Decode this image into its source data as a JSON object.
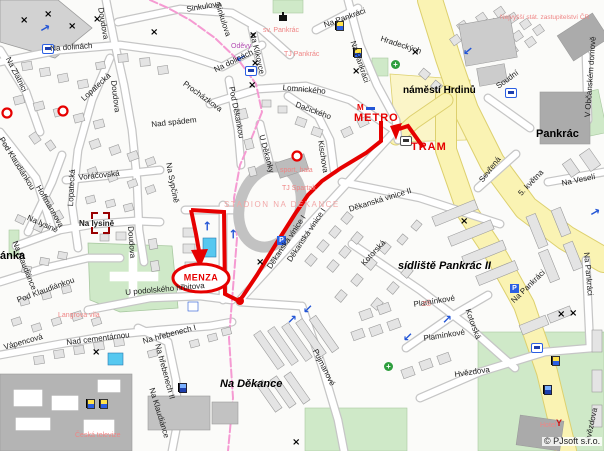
{
  "map": {
    "copyright": "© PJsoft s.r.o.",
    "colors": {
      "route_red": "#e60000",
      "boundary_pink": "#f59ad2",
      "road_yellow": "#faf3b3",
      "park_green": "#cfe9c8",
      "highlight_building_cyan": "#56c8f0",
      "poi_pink": "#ef8585",
      "shop_purple": "#b44fb4"
    },
    "route": {
      "metro_label": "METRO",
      "tram_label": "TRAM",
      "destination_label": "MENZA"
    },
    "districts": [
      "náměstí Hrdinů",
      "sídliště Pankrác II",
      "Pankrác",
      "Na Děkance",
      "ánka"
    ],
    "streets": [
      "Sinkulova",
      "Sinkulova",
      "Doudova",
      "Doudova",
      "Doudova",
      "Na dolinách",
      "Na dolinách",
      "Na Zlatnici",
      "Lopatecká",
      "Lopatecká",
      "Voráčovská",
      "Hoffmannova",
      "Pod Klaudiánkou",
      "Pod Klaudiánkou",
      "Na lysině",
      "Na lysině",
      "Na Klaudiánce",
      "Na Klaudiánce",
      "U podolského hřbitova",
      "Vápencová",
      "Nad cementárnou",
      "Na hřebenech I",
      "Na hřebenech II",
      "Pujmanové",
      "Na Klikovce",
      "Lomnického",
      "Pod Děkankou",
      "U Děkanky",
      "Dačického",
      "Kischova",
      "Děkanská vinice I",
      "Děkanská vinice I",
      "Děkanská vinice II",
      "Kotorská",
      "Kotorská",
      "Plamínkové",
      "Plamínkové",
      "Hvězdova",
      "Hvězdova",
      "5. května",
      "Na Veselí",
      "Sevřená",
      "Soudní",
      "Na Pankráci",
      "Na Pankráci",
      "Na Pankráci",
      "Na Pankráci",
      "Hradeckých",
      "Procházkova",
      "Nad spádem",
      "Na Sypčině",
      "V Občanském domově"
    ],
    "pois": [
      "sv. Pankrác",
      "TJ Pankrác",
      "Oděvy",
      "sport. hala",
      "TJ Spartak",
      "STADION NA DĚKANCE",
      "Langrova vila",
      "Česká televize",
      "ZŠ",
      "Hotel",
      "Nejvyšší stát. zastupitelství ČR"
    ],
    "icons": {
      "bus-stop-icon": "white square, blue border, bus glyph",
      "tram-stop-icon": "white square, gray border, tram glyph",
      "parking-icon": "blue square with white P",
      "one-way-arrow-icon": "blue arrow",
      "crossing-icon": "black x mark",
      "flag-icon": "yellow/blue flag",
      "flag-icon-blue": "blue flag",
      "pharmacy-icon": "green circle with white cross",
      "church-icon": "black chapel",
      "restaurant-icon": "red glass",
      "metro-icon": "red M with blue dash",
      "route-destination-oval": "red oval outline",
      "route-arrow": "red arrowhead",
      "stop-circle-icon": "red ring",
      "selection-brackets-icon": "dark red corner brackets"
    }
  }
}
